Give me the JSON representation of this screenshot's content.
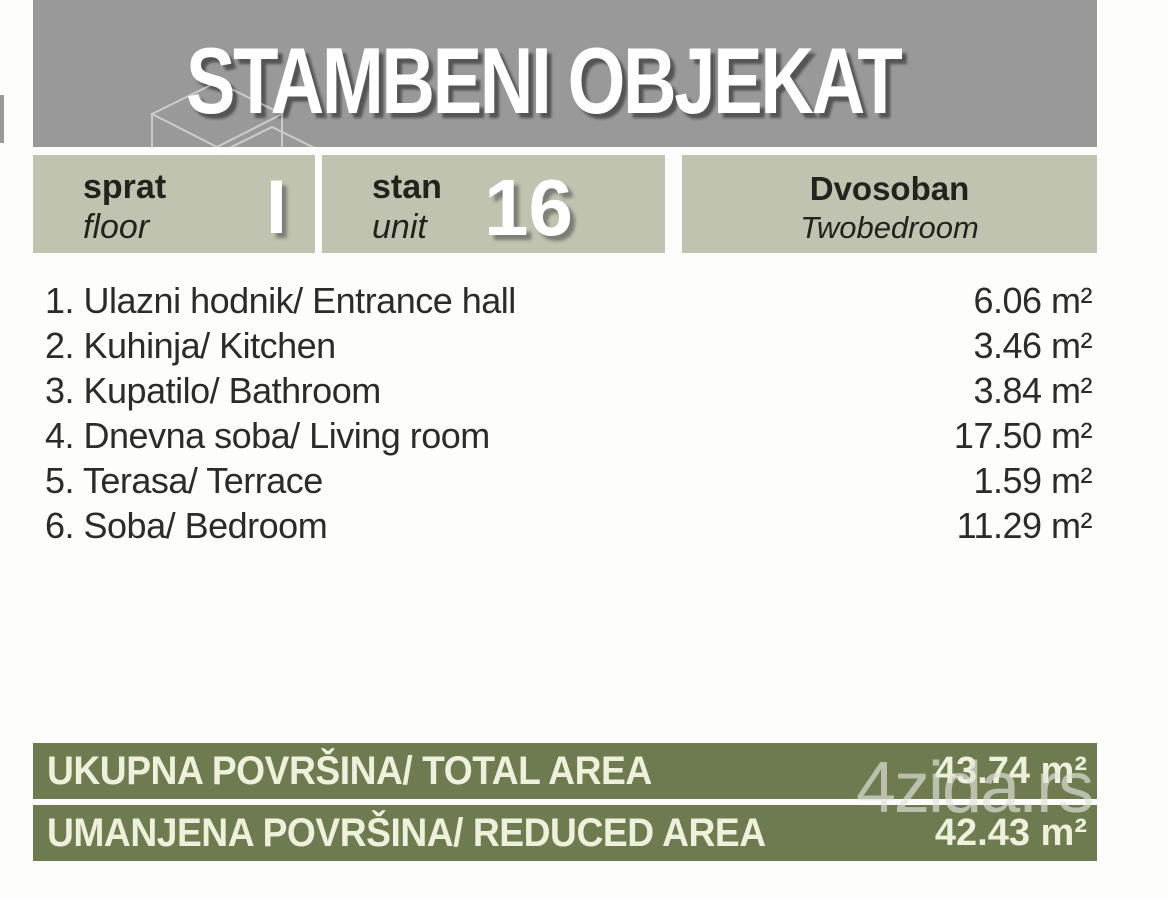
{
  "header": {
    "title": "STAMBENI OBJEKAT"
  },
  "info": {
    "floor_label_sr": "sprat",
    "floor_label_en": "floor",
    "floor_value": "I",
    "unit_label_sr": "stan",
    "unit_label_en": "unit",
    "unit_value": "16",
    "type_sr": "Dvosoban",
    "type_en": "Twobedroom"
  },
  "rooms": [
    {
      "label": "1. Ulazni hodnik/ Entrance hall",
      "area": "6.06 m²"
    },
    {
      "label": "2. Kuhinja/ Kitchen",
      "area": "3.46 m²"
    },
    {
      "label": "3. Kupatilo/ Bathroom",
      "area": "3.84 m²"
    },
    {
      "label": "4. Dnevna soba/ Living room",
      "area": "17.50 m²"
    },
    {
      "label": "5. Terasa/ Terrace",
      "area": "1.59 m²"
    },
    {
      "label": "6. Soba/ Bedroom",
      "area": "11.29 m²"
    }
  ],
  "totals": [
    {
      "label": "UKUPNA POVRŠINA/ TOTAL AREA",
      "value": "43.74 m²"
    },
    {
      "label": "UMANJENA POVRŠINA/ REDUCED AREA",
      "value": "42.43 m²"
    }
  ],
  "watermark": "4zida.rs",
  "colors": {
    "banner_gray": "#9a999a",
    "box_sage": "#c1c3b1",
    "bar_olive": "#6e7b50",
    "bar_text_cream": "#edf0da",
    "body_text": "#2b2b2b"
  }
}
